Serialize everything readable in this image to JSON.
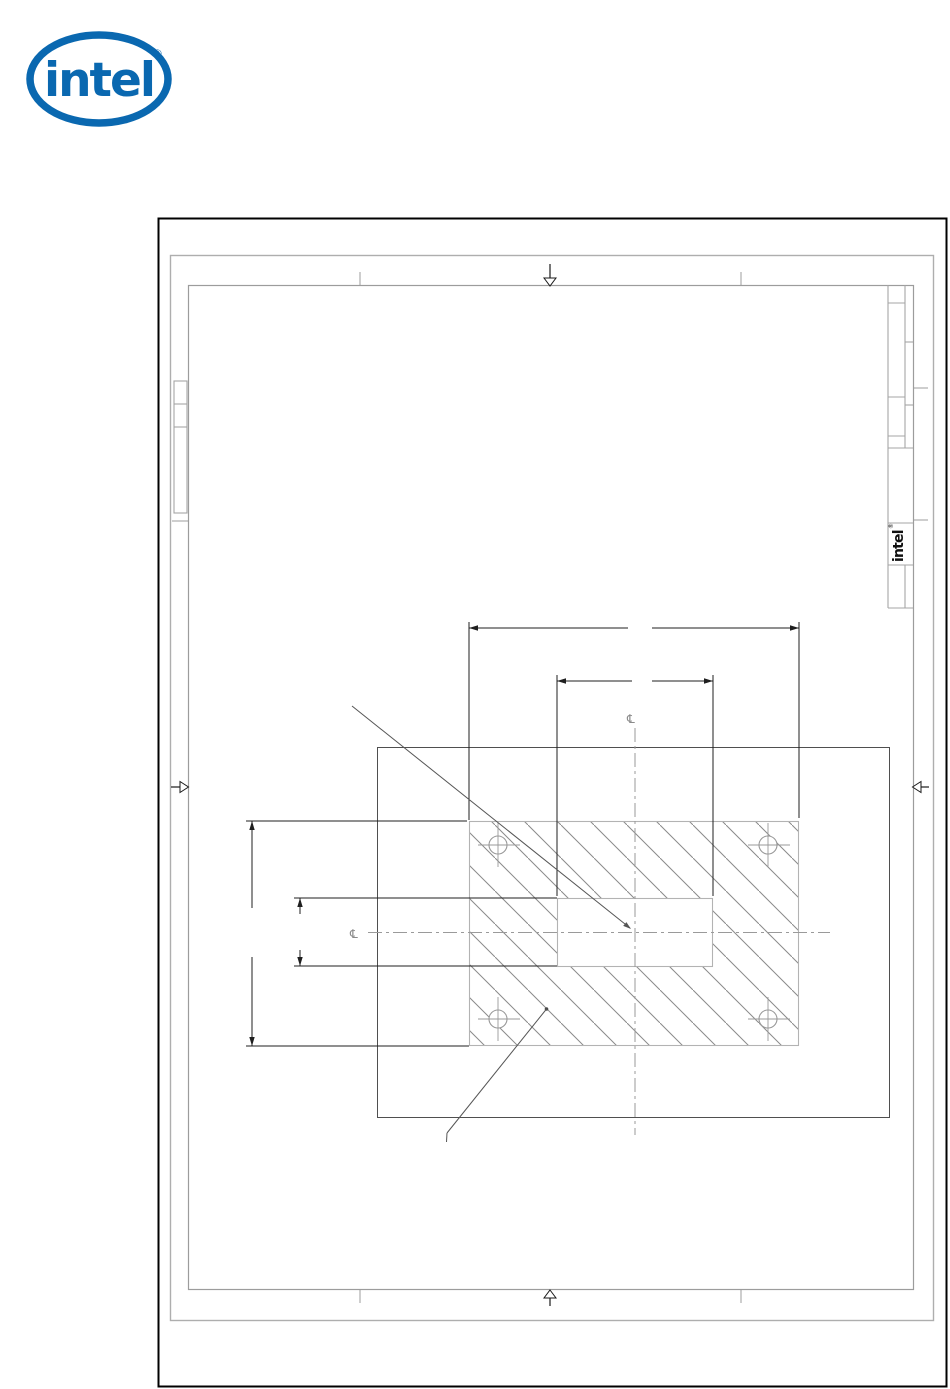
{
  "brand": {
    "logo_text": "intel",
    "registered": "®",
    "logo_color": "#0a68b0"
  },
  "title_block": {
    "logo_text": "intel",
    "registered": "®"
  },
  "drawing": {
    "centerline_symbol_top": "℄",
    "centerline_symbol_left": "℄",
    "colors": {
      "sheet_outer_border": "#000000",
      "sheet_inner_frame": "#9c9c9c",
      "object_line": "#4f4f4f",
      "dimension_line": "#1f1f1f",
      "hatch_line": "#8a8a8a",
      "centerline": "#9a9a9a",
      "section_border": "#b3b3b3"
    }
  }
}
